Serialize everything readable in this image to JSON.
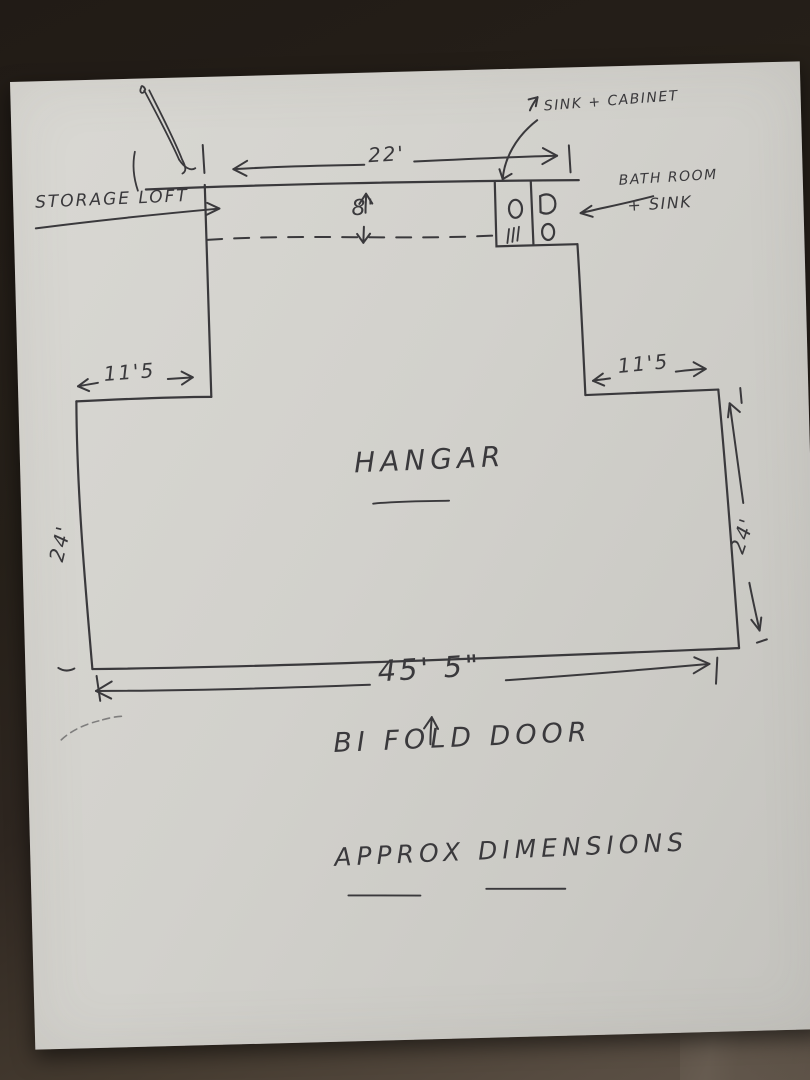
{
  "sketch": {
    "room_label": "HANGAR",
    "caption": "APPROX DIMENSIONS",
    "labels": {
      "storage_loft": "STORAGE LOFT",
      "sink_cabinet": "SINK + CABINET",
      "bathroom_line1": "BATH ROOM",
      "bathroom_line2": "+ SINK",
      "bifold_door": "BI FOLD DOOR"
    },
    "dimensions": {
      "top_wall_width": "22'",
      "loft_depth": "8'",
      "left_wing_width": "11'5",
      "right_wing_width": "11'5",
      "left_side_height": "24'",
      "right_side_height": "24'",
      "door_width": "45' 5\""
    },
    "colors": {
      "ink": "#3a393c",
      "paper": "#d0cfca",
      "background_dark": "#26201a",
      "background_light": "#574c41"
    }
  }
}
